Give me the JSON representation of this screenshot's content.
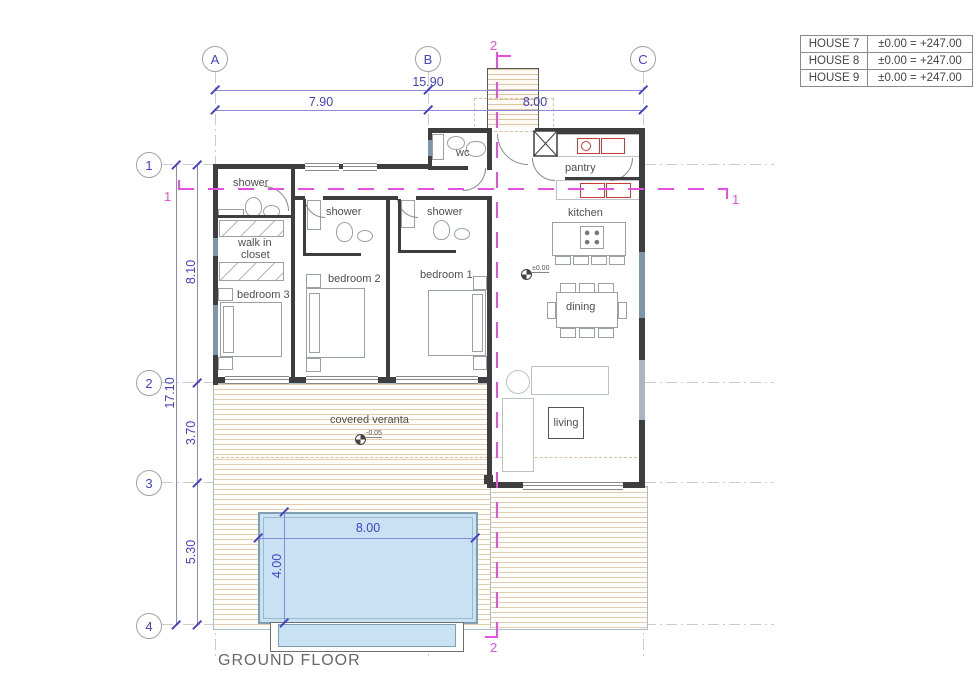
{
  "title": "GROUND FLOOR",
  "houses_table": {
    "rows": [
      {
        "name": "HOUSE 7",
        "level": "±0.00 = +247.00"
      },
      {
        "name": "HOUSE 8",
        "level": "±0.00 = +247.00"
      },
      {
        "name": "HOUSE 9",
        "level": "±0.00 = +247.00"
      }
    ]
  },
  "grid": {
    "col_a": "A",
    "col_b": "B",
    "col_c": "C",
    "row_1": "1",
    "row_2": "2",
    "row_3": "3",
    "row_4": "4"
  },
  "dimensions": {
    "top_total": "15.90",
    "top_ab": "7.90",
    "top_bc": "8.00",
    "left_total": "17.10",
    "left_12": "8.10",
    "left_23": "3.70",
    "left_34": "5.30",
    "pool_width": "8.00",
    "pool_height": "4.00"
  },
  "sections": {
    "section_1": "1",
    "section_2": "2"
  },
  "levels": {
    "interior": "±0.00",
    "veranda": "-0.05"
  },
  "rooms": {
    "shower_1": "shower",
    "walk_in_line1": "walk in",
    "walk_in_line2": "closet",
    "bedroom_3": "bedroom 3",
    "shower_2": "shower",
    "bedroom_2": "bedroom 2",
    "shower_3": "shower",
    "bedroom_1": "bedroom 1",
    "wc": "wc",
    "pantry": "pantry",
    "kitchen": "kitchen",
    "dining": "dining",
    "living": "living",
    "veranda": "covered veranta"
  },
  "colors": {
    "dimension_blue": "#4341cc",
    "section_magenta": "#e74fe0",
    "wall": "#3e3e40",
    "deck_hatch": "#e2ceae",
    "pool_fill": "#c8e2f4",
    "appliance_red": "#cc3a34"
  }
}
